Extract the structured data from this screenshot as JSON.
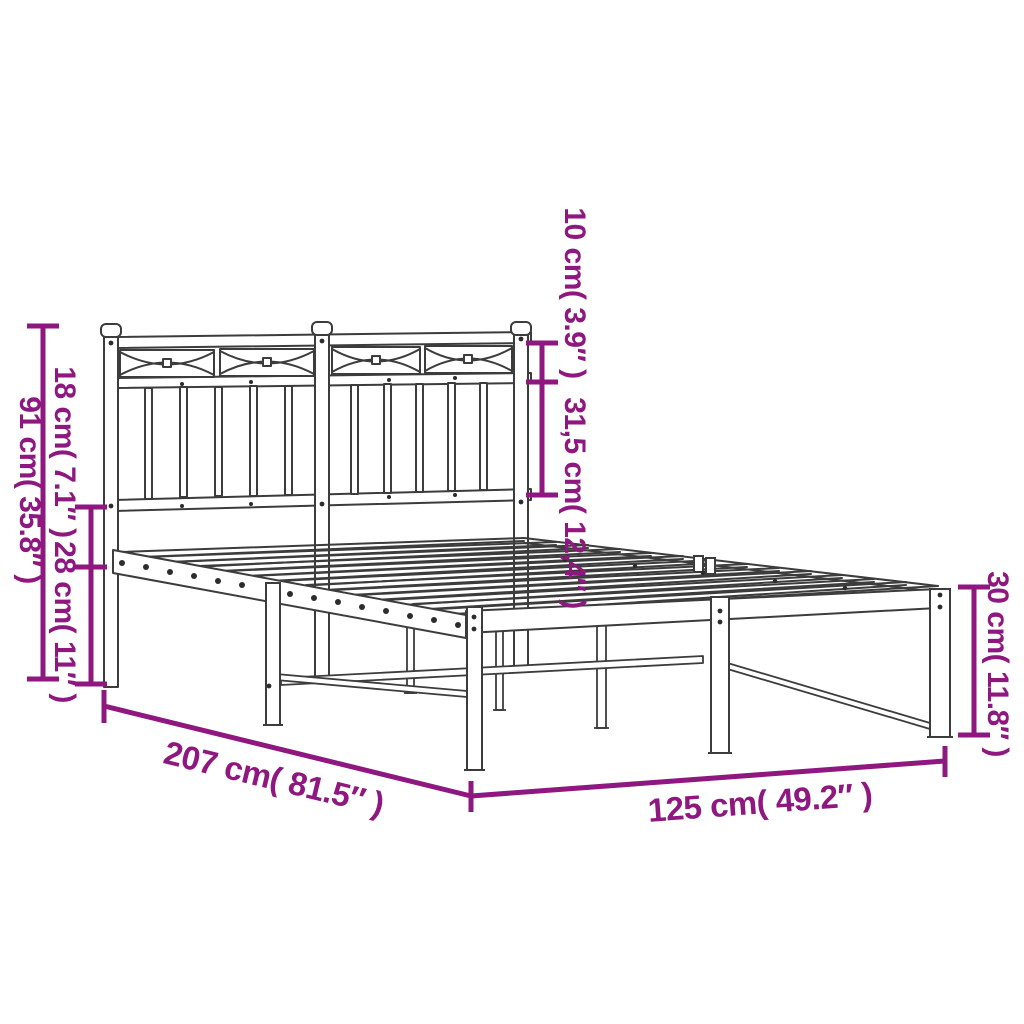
{
  "colors": {
    "accent": "#8e1780",
    "line": "#3c3c3c",
    "background": "#ffffff"
  },
  "dims": {
    "headboard_height": {
      "label": "91 cm( 35.8″ )"
    },
    "headboard_upper": {
      "label": "18 cm( 7.1″ )"
    },
    "base_height": {
      "label": "28 cm( 11″ )"
    },
    "decor_height": {
      "label": "10 cm( 3.9″ )"
    },
    "panel_height": {
      "label": "31,5 cm( 12,4″ )"
    },
    "leg_height": {
      "label": "30 cm( 11.8″ )"
    },
    "length": {
      "label": "207 cm( 81.5″ )"
    },
    "width": {
      "label": "125 cm( 49.2″ )"
    }
  }
}
